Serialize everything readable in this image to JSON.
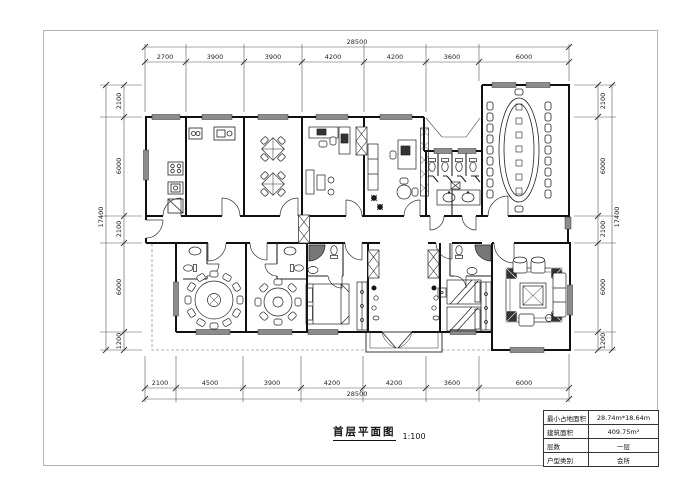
{
  "title": {
    "text": "首层平面图",
    "scale": "1:100"
  },
  "dimensions": {
    "top": {
      "total": "28500",
      "segments": [
        "2700",
        "3900",
        "3900",
        "4200",
        "4200",
        "3600",
        "6000"
      ]
    },
    "bottom": {
      "total": "28500",
      "segments": [
        "2100",
        "4500",
        "3900",
        "4200",
        "4200",
        "3600",
        "6000"
      ]
    },
    "left": {
      "total": "17400",
      "segments": [
        "2100",
        "6000",
        "2100",
        "6000",
        "1200"
      ]
    },
    "right": {
      "total": "17400",
      "segments": [
        "2100",
        "6000",
        "2100",
        "6000",
        "1200"
      ]
    }
  },
  "info_table": {
    "rows": [
      {
        "label": "最小占地面积",
        "value": "28.74m*18.64m"
      },
      {
        "label": "建筑面积",
        "value": "409.75m²"
      },
      {
        "label": "层数",
        "value": "一层"
      },
      {
        "label": "户型类别",
        "value": "会所"
      }
    ]
  },
  "colors": {
    "wall": "#111111",
    "window_fill": "#8c8c8c",
    "dimension_line": "#444444",
    "frame": "#b3b3b3"
  }
}
